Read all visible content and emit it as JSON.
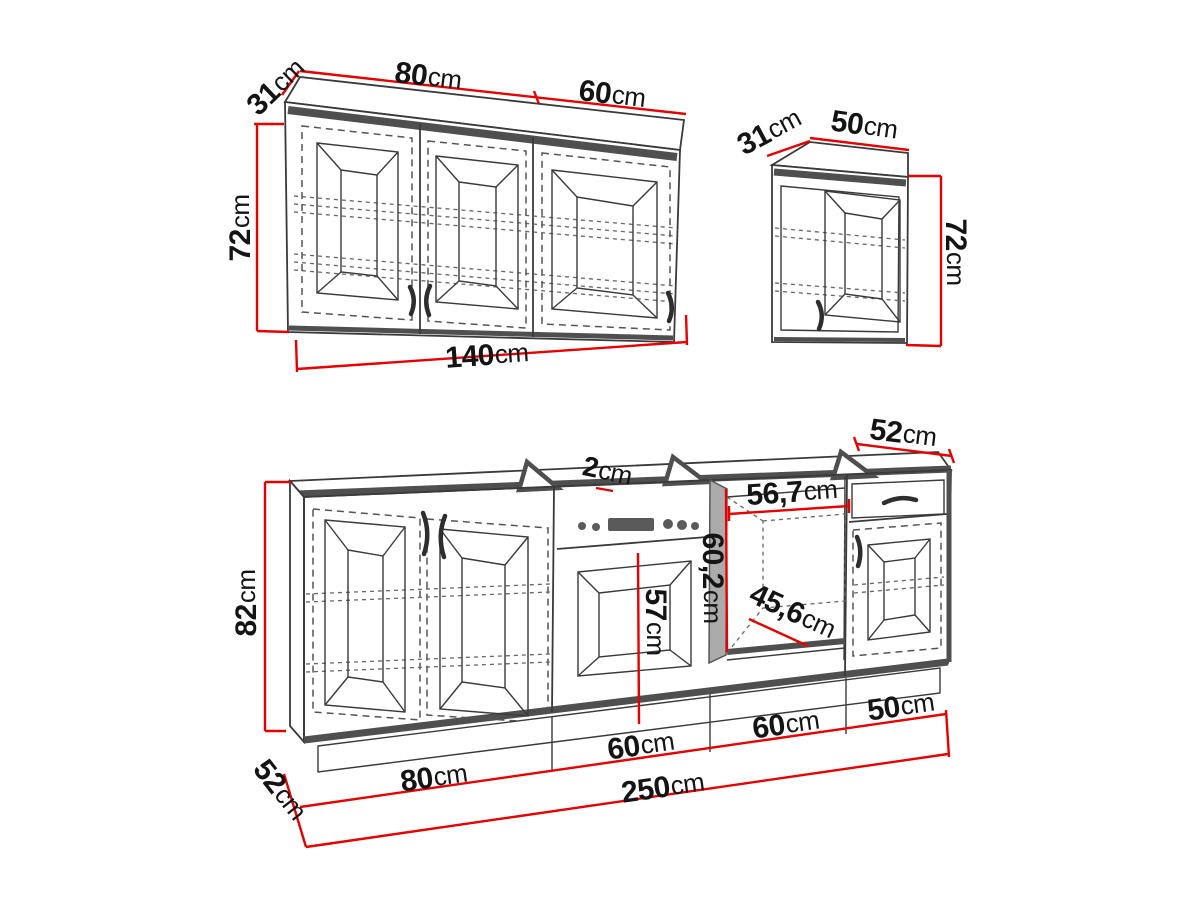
{
  "unit": "cm",
  "colors": {
    "dimension_line": "#e60000",
    "outline": "#3a3a3a",
    "band_gray": "#4f4f4f",
    "niche_wall_gray": "#aaaaaa",
    "display_fill": "#5a5a5a"
  },
  "wall_cabinet_left": {
    "depth": "31",
    "left_section_width": "80",
    "right_section_width": "60",
    "height": "72",
    "total_width": "140"
  },
  "wall_cabinet_right": {
    "depth": "31",
    "width": "50",
    "height": "72"
  },
  "base_run": {
    "height": "82",
    "plinth_depth": "52",
    "worktop_thickness": "2",
    "oven_door_height": "57",
    "niche_width": "56,7",
    "niche_height": "60,2",
    "niche_floor_depth": "45,6",
    "cabinet_width_1": "80",
    "cabinet_width_2": "60",
    "cabinet_width_3": "60",
    "cabinet_width_4": "50",
    "total_width": "250",
    "right_cabinet_depth": "52"
  }
}
